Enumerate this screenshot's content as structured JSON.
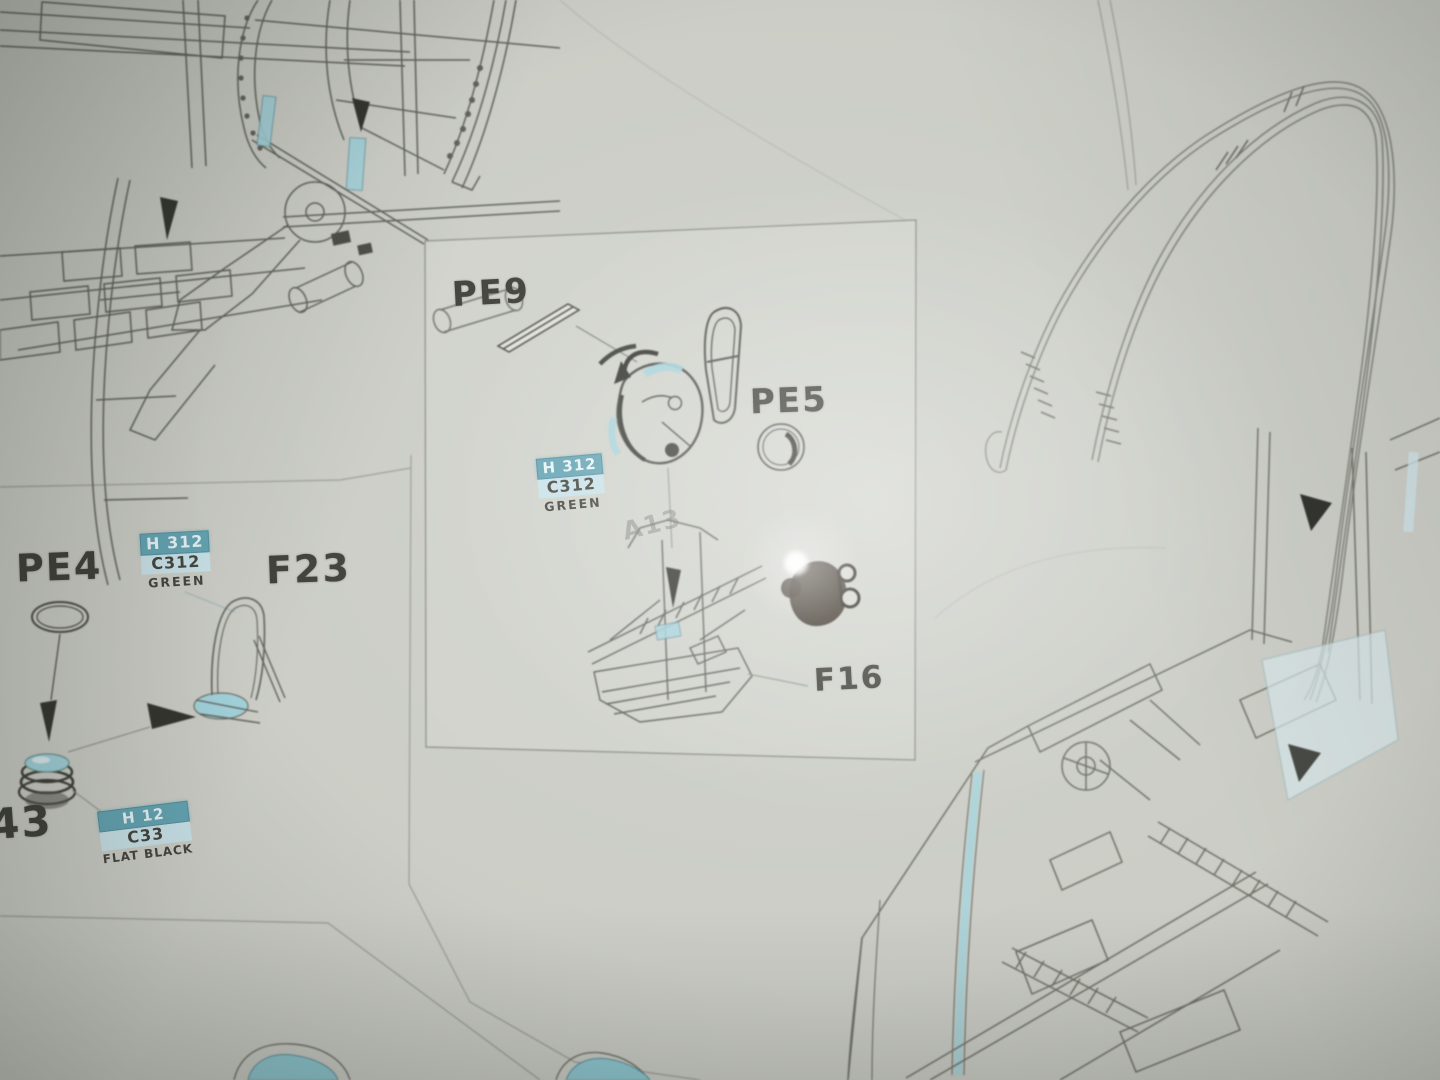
{
  "inset_panel": {
    "pe9_label": "PE9",
    "pe5_label": "PE5",
    "f16_label": "F16",
    "a13_label": "A13",
    "paint_callout_green": {
      "code_h": "H 312",
      "code_c": "C312",
      "color_name": "GREEN"
    }
  },
  "left_panel": {
    "pe4_label": "PE4",
    "f23_label": "F23",
    "part_43_label": "43",
    "paint_callout_green": {
      "code_h": "H 312",
      "code_c": "C312",
      "color_name": "GREEN"
    },
    "paint_callout_black": {
      "code_h": "H 12",
      "code_c": "C33",
      "color_name": "FLAT BLACK"
    }
  },
  "colors": {
    "paper": "#cbcdc6",
    "ink_line": "#63655e",
    "ink_dark": "#33342e",
    "part_highlight_teal": "#a3d2db",
    "callout_header_bg": "#63a3b2",
    "callout_header_text": "#e7f3f5",
    "callout_code_bg": "#c8e2e8",
    "glare": "#ffffff"
  }
}
